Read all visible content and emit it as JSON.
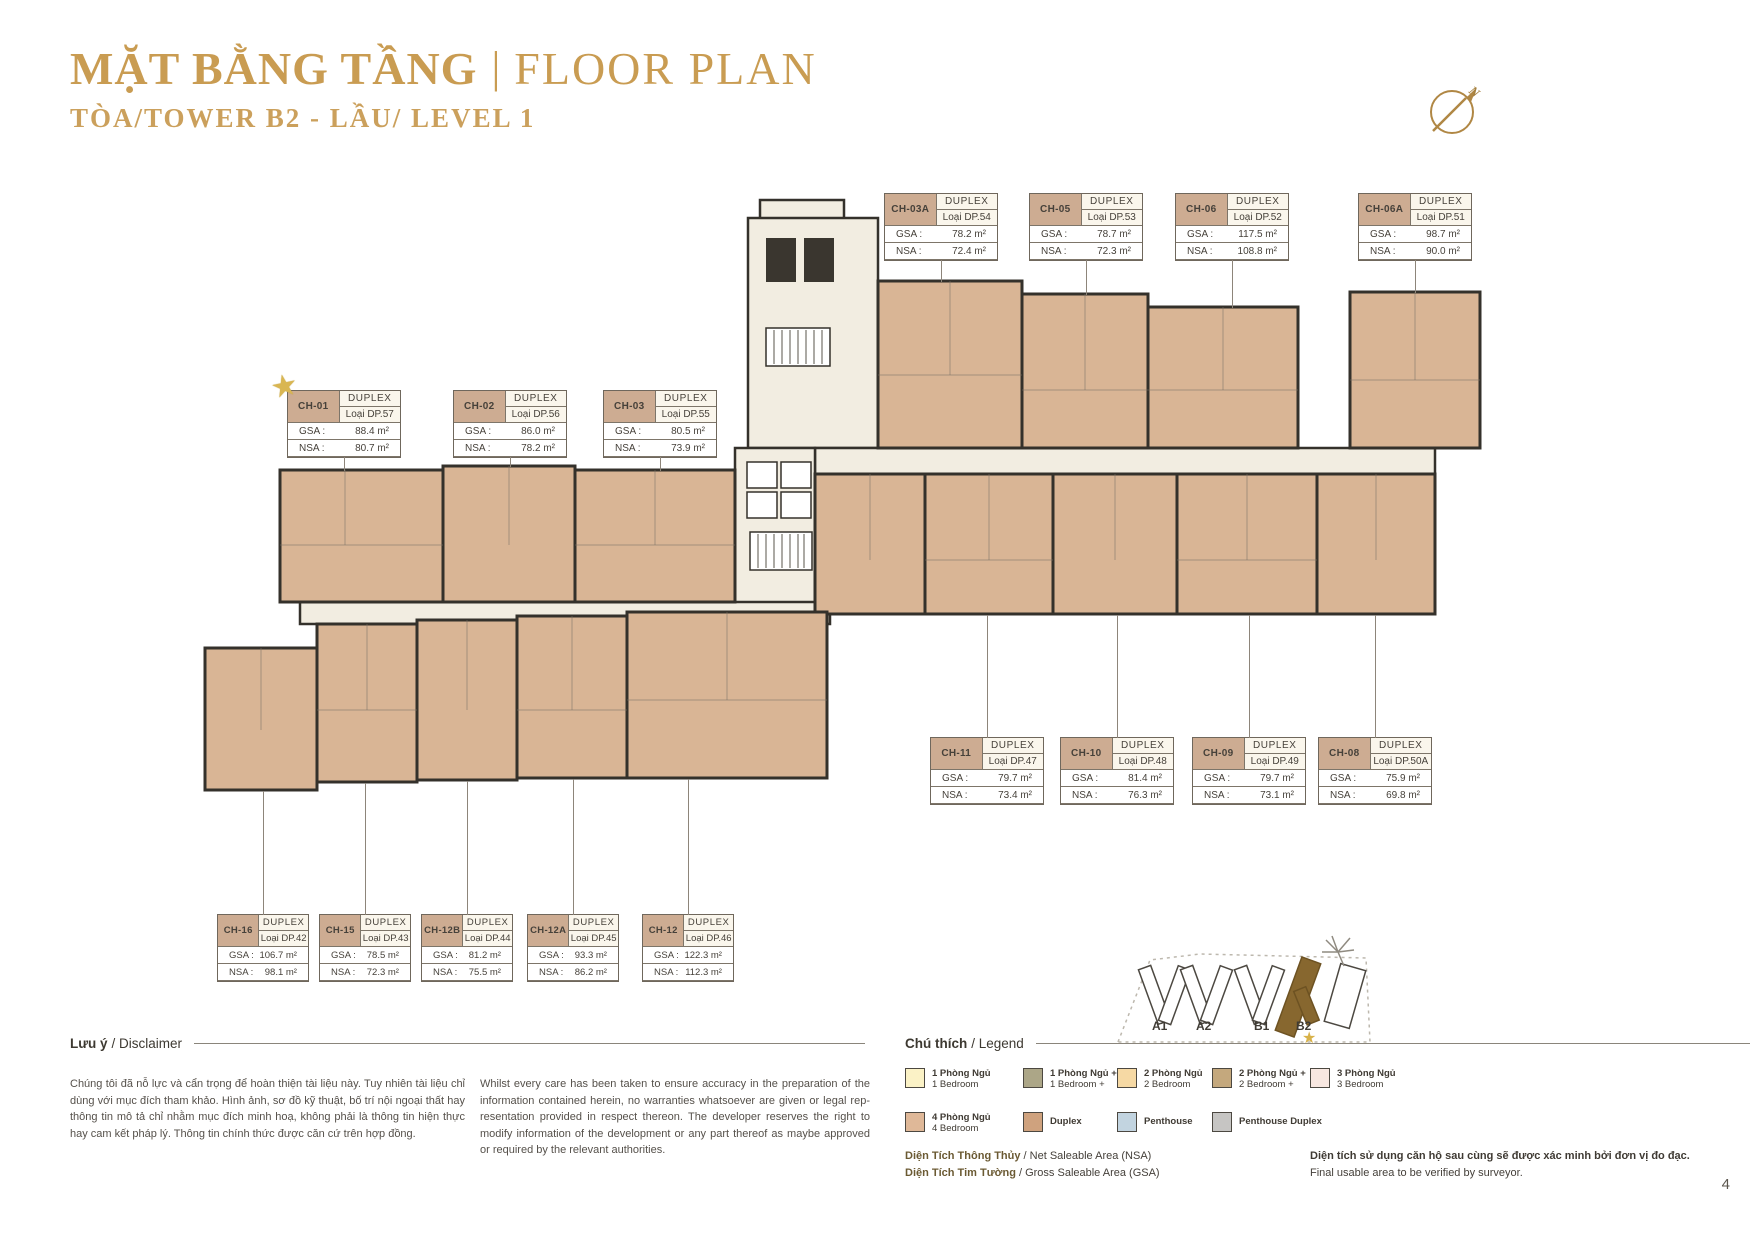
{
  "header": {
    "title_vn": "MẶT BẰNG TẦNG",
    "separator": "|",
    "title_en": "FLOOR PLAN",
    "subtitle": "TÒA/TOWER B2 - LẦU/ LEVEL 1",
    "compass": "N"
  },
  "labels": {
    "duplex": "DUPLEX",
    "gsa": "GSA :",
    "nsa": "NSA :"
  },
  "icons": {
    "star": "★"
  },
  "units": [
    {
      "code": "CH-03A",
      "loai": "Loại DP.54",
      "gsa": "78.2 m²",
      "nsa": "72.4 m²",
      "x": 884,
      "y": 193,
      "leader_dir": "down",
      "leader_len": 22
    },
    {
      "code": "CH-05",
      "loai": "Loại DP.53",
      "gsa": "78.7 m²",
      "nsa": "72.3 m²",
      "x": 1029,
      "y": 193,
      "leader_dir": "down",
      "leader_len": 35
    },
    {
      "code": "CH-06",
      "loai": "Loại DP.52",
      "gsa": "117.5 m²",
      "nsa": "108.8 m²",
      "x": 1175,
      "y": 193,
      "leader_dir": "down",
      "leader_len": 48
    },
    {
      "code": "CH-06A",
      "loai": "Loại DP.51",
      "gsa": "98.7 m²",
      "nsa": "90.0 m²",
      "x": 1358,
      "y": 193,
      "leader_dir": "down",
      "leader_len": 33
    },
    {
      "code": "CH-01",
      "loai": "Loại DP.57",
      "gsa": "88.4 m²",
      "nsa": "80.7 m²",
      "x": 287,
      "y": 390,
      "star": true,
      "leader_dir": "down",
      "leader_len": 14
    },
    {
      "code": "CH-02",
      "loai": "Loại DP.56",
      "gsa": "86.0 m²",
      "nsa": "78.2 m²",
      "x": 453,
      "y": 390,
      "leader_dir": "down",
      "leader_len": 10
    },
    {
      "code": "CH-03",
      "loai": "Loại DP.55",
      "gsa": "80.5 m²",
      "nsa": "73.9 m²",
      "x": 603,
      "y": 390,
      "leader_dir": "down",
      "leader_len": 14
    },
    {
      "code": "CH-11",
      "loai": "Loại DP.47",
      "gsa": "79.7 m²",
      "nsa": "73.4 m²",
      "x": 930,
      "y": 737,
      "leader_dir": "up",
      "leader_len": 123
    },
    {
      "code": "CH-10",
      "loai": "Loại DP.48",
      "gsa": "81.4 m²",
      "nsa": "76.3 m²",
      "x": 1060,
      "y": 737,
      "leader_dir": "up",
      "leader_len": 123
    },
    {
      "code": "CH-09",
      "loai": "Loại DP.49",
      "gsa": "79.7 m²",
      "nsa": "73.1 m²",
      "x": 1192,
      "y": 737,
      "leader_dir": "up",
      "leader_len": 123
    },
    {
      "code": "CH-08",
      "loai": "Loại DP.50A",
      "gsa": "75.9 m²",
      "nsa": "69.8 m²",
      "x": 1318,
      "y": 737,
      "leader_dir": "up",
      "leader_len": 123
    },
    {
      "code": "CH-16",
      "loai": "Loại DP.42",
      "gsa": "106.7 m²",
      "nsa": "98.1 m²",
      "x": 217,
      "y": 914,
      "w": 90,
      "leader_dir": "up",
      "leader_len": 124
    },
    {
      "code": "CH-15",
      "loai": "Loại DP.43",
      "gsa": "78.5 m²",
      "nsa": "72.3 m²",
      "x": 319,
      "y": 914,
      "w": 90,
      "leader_dir": "up",
      "leader_len": 132
    },
    {
      "code": "CH-12B",
      "loai": "Loại DP.44",
      "gsa": "81.2 m²",
      "nsa": "75.5 m²",
      "x": 421,
      "y": 914,
      "w": 90,
      "leader_dir": "up",
      "leader_len": 134
    },
    {
      "code": "CH-12A",
      "loai": "Loại DP.45",
      "gsa": "93.3 m²",
      "nsa": "86.2 m²",
      "x": 527,
      "y": 914,
      "w": 90,
      "leader_dir": "up",
      "leader_len": 136
    },
    {
      "code": "CH-12",
      "loai": "Loại DP.46",
      "gsa": "122.3 m²",
      "nsa": "112.3 m²",
      "x": 642,
      "y": 914,
      "w": 90,
      "leader_dir": "up",
      "leader_len": 136
    }
  ],
  "disclaimer": {
    "heading_vn": "Lưu ý",
    "heading_en": "/ Disclaimer",
    "text_vn": "Chúng tôi đã nỗ lực và cẩn trọng để hoàn thiện tài liệu này. Tuy nhiên tài liệu chỉ dùng với mục đích tham khảo. Hình ảnh, sơ đồ kỹ thuật, bố trí nội ngoại thất hay thông tin mô tả chỉ nhằm mục đích minh hoạ, không phải là thông tin hiện thực hay cam kết pháp lý. Thông tin chính thức được căn cứ trên hợp đồng.",
    "text_en": "Whilst every care has been taken to ensure accuracy in the preparation of the information contained herein, no warranties whatsoever are given or legal rep-resentation provided in respect thereon. The developer reserves the right to modify information of the development or any part thereof as maybe approved or required by the relevant authorities."
  },
  "legend": {
    "heading_vn": "Chú thích",
    "heading_en": "/ Legend",
    "items": [
      {
        "vn": "1 Phòng Ngủ",
        "en": "1 Bedroom",
        "color": "#FBF2C6",
        "cx": 0,
        "cy": 0
      },
      {
        "vn": "1 Phòng Ngủ +",
        "en": "1 Bedroom +",
        "color": "#ACA687",
        "cx": 118,
        "cy": 0
      },
      {
        "vn": "2 Phòng Ngủ",
        "en": "2 Bedroom",
        "color": "#F6D9A4",
        "cx": 212,
        "cy": 0
      },
      {
        "vn": "2 Phòng Ngủ +",
        "en": "2 Bedroom +",
        "color": "#C4A87D",
        "cx": 307,
        "cy": 0
      },
      {
        "vn": "3 Phòng Ngủ",
        "en": "3 Bedroom",
        "color": "#F8E7E0",
        "cx": 405,
        "cy": 0
      },
      {
        "vn": "4 Phòng Ngủ",
        "en": "4 Bedroom",
        "color": "#DFB898",
        "cx": 0,
        "cy": 44
      },
      {
        "vn": "Duplex",
        "en": "",
        "color": "#CFA27E",
        "cx": 118,
        "cy": 44
      },
      {
        "vn": "Penthouse",
        "en": "",
        "color": "#C2D4E0",
        "cx": 212,
        "cy": 44
      },
      {
        "vn": "Penthouse Duplex",
        "en": "",
        "color": "#C6C5C3",
        "cx": 307,
        "cy": 44
      }
    ]
  },
  "area_notes": {
    "nsa_vn": "Diện Tích Thông Thủy",
    "nsa_en": " / Net Saleable Area (NSA)",
    "gsa_vn": "Diện Tích Tim Tường",
    "gsa_en": " / Gross Saleable Area (GSA)",
    "note_vn": "Diện tích sử dụng căn hộ sau cùng sẽ được xác minh bởi đơn vị đo đạc.",
    "note_en": "Final usable area to be verified by surveyor."
  },
  "minimap": {
    "towers": [
      "A1",
      "A2",
      "B1",
      "B2"
    ],
    "highlight": "B2"
  },
  "page_number": "4"
}
